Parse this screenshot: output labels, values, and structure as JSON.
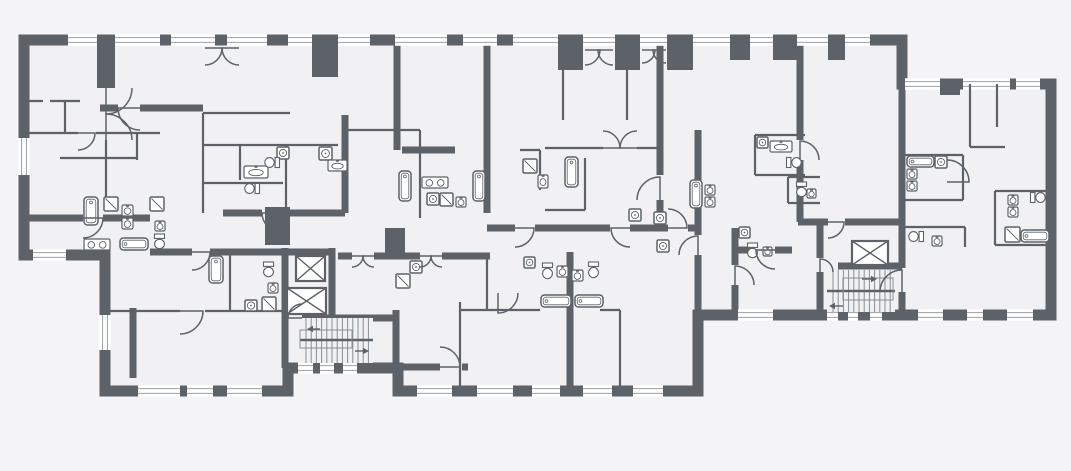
{
  "meta": {
    "kind": "architectural-floor-plan",
    "width": 1071,
    "height": 471
  },
  "palette": {
    "bg": "#f4f4f6",
    "room": "#f1f1f3",
    "wall": "#5c6268",
    "glass": "#9aa1a7",
    "tread": "#878e94",
    "white": "#ffffff"
  },
  "footprint": [
    [
      24,
      40
    ],
    [
      902,
      40
    ],
    [
      902,
      84
    ],
    [
      1051,
      84
    ],
    [
      1051,
      315
    ],
    [
      698,
      315
    ],
    [
      698,
      391
    ],
    [
      398,
      391
    ],
    [
      398,
      368
    ],
    [
      288,
      368
    ],
    [
      288,
      391
    ],
    [
      105,
      391
    ],
    [
      105,
      255
    ],
    [
      24,
      255
    ]
  ],
  "walls": [
    [
      397,
      45,
      397,
      150
    ],
    [
      345,
      115,
      345,
      213
    ],
    [
      402,
      150,
      455,
      150
    ],
    [
      487,
      45,
      487,
      213
    ],
    [
      660,
      45,
      660,
      175
    ],
    [
      660,
      200,
      660,
      228
    ],
    [
      800,
      45,
      800,
      140
    ],
    [
      800,
      160,
      800,
      222
    ],
    [
      902,
      84,
      902,
      268
    ],
    [
      902,
      292,
      902,
      315
    ],
    [
      820,
      222,
      820,
      258
    ],
    [
      820,
      272,
      820,
      315
    ],
    [
      735,
      228,
      735,
      265
    ],
    [
      735,
      285,
      735,
      315
    ],
    [
      285,
      248,
      285,
      368
    ],
    [
      332,
      248,
      332,
      318
    ],
    [
      223,
      213,
      262,
      213
    ],
    [
      280,
      213,
      345,
      213
    ],
    [
      150,
      252,
      192,
      252
    ],
    [
      210,
      252,
      332,
      252
    ],
    [
      487,
      228,
      515,
      228
    ],
    [
      535,
      228,
      610,
      228
    ],
    [
      630,
      228,
      668,
      228
    ],
    [
      688,
      228,
      698,
      228
    ],
    [
      698,
      130,
      698,
      235
    ],
    [
      698,
      255,
      698,
      315
    ],
    [
      338,
      256,
      352,
      256
    ],
    [
      374,
      256,
      420,
      256
    ],
    [
      442,
      256,
      490,
      256
    ],
    [
      736,
      250,
      755,
      250
    ],
    [
      775,
      250,
      792,
      250
    ],
    [
      798,
      222,
      828,
      222
    ],
    [
      845,
      222,
      902,
      222
    ],
    [
      838,
      266,
      902,
      266
    ],
    [
      302,
      318,
      396,
      318
    ],
    [
      396,
      310,
      396,
      368
    ],
    [
      24,
      218,
      83,
      218
    ],
    [
      103,
      218,
      150,
      218
    ],
    [
      100,
      108,
      118,
      108
    ],
    [
      140,
      108,
      203,
      108
    ],
    [
      133,
      308,
      133,
      378
    ],
    [
      570,
      252,
      570,
      391
    ],
    [
      398,
      367,
      440,
      367
    ],
    [
      462,
      367,
      468,
      367
    ]
  ],
  "piers": [
    [
      97,
      45,
      18,
      43
    ],
    [
      312,
      45,
      26,
      32
    ],
    [
      558,
      45,
      25,
      25
    ],
    [
      615,
      45,
      25,
      25
    ],
    [
      667,
      45,
      26,
      25
    ],
    [
      730,
      45,
      20,
      15
    ],
    [
      773,
      45,
      24,
      15
    ],
    [
      828,
      45,
      17,
      15
    ],
    [
      940,
      84,
      20,
      11
    ],
    [
      265,
      207,
      25,
      38
    ],
    [
      385,
      228,
      20,
      28
    ]
  ],
  "thin_walls": [
    [
      24,
      101,
      43,
      101
    ],
    [
      50,
      101,
      80,
      101
    ],
    [
      65,
      101,
      65,
      133
    ],
    [
      24,
      133,
      78,
      133
    ],
    [
      96,
      133,
      160,
      133
    ],
    [
      137,
      133,
      137,
      160
    ],
    [
      60,
      158,
      137,
      158
    ],
    [
      106,
      140,
      106,
      198
    ],
    [
      203,
      113,
      203,
      213
    ],
    [
      203,
      113,
      290,
      113
    ],
    [
      203,
      145,
      338,
      145
    ],
    [
      240,
      145,
      240,
      180
    ],
    [
      203,
      183,
      283,
      183
    ],
    [
      286,
      145,
      286,
      213
    ],
    [
      345,
      130,
      420,
      130
    ],
    [
      420,
      130,
      420,
      218
    ],
    [
      520,
      150,
      540,
      150
    ],
    [
      540,
      150,
      540,
      190
    ],
    [
      585,
      158,
      585,
      210
    ],
    [
      545,
      210,
      585,
      210
    ],
    [
      627,
      45,
      627,
      120
    ],
    [
      563,
      70,
      563,
      120
    ],
    [
      545,
      148,
      603,
      148
    ],
    [
      637,
      148,
      660,
      148
    ],
    [
      755,
      135,
      805,
      135
    ],
    [
      755,
      135,
      755,
      175
    ],
    [
      755,
      175,
      805,
      175
    ],
    [
      788,
      177,
      820,
      177
    ],
    [
      788,
      177,
      788,
      203
    ],
    [
      788,
      203,
      820,
      203
    ],
    [
      970,
      84,
      970,
      147
    ],
    [
      970,
      147,
      1005,
      147
    ],
    [
      997,
      84,
      997,
      127
    ],
    [
      905,
      155,
      963,
      155
    ],
    [
      963,
      155,
      963,
      200
    ],
    [
      905,
      200,
      963,
      200
    ],
    [
      995,
      191,
      1051,
      191
    ],
    [
      995,
      191,
      995,
      245
    ],
    [
      995,
      245,
      1051,
      245
    ],
    [
      905,
      227,
      965,
      227
    ],
    [
      965,
      227,
      965,
      247
    ],
    [
      105,
      311,
      180,
      311
    ],
    [
      205,
      311,
      283,
      311
    ],
    [
      230,
      252,
      230,
      311
    ],
    [
      460,
      302,
      460,
      388
    ],
    [
      620,
      310,
      620,
      391
    ],
    [
      487,
      256,
      487,
      310
    ],
    [
      460,
      310,
      540,
      310
    ],
    [
      600,
      310,
      620,
      310
    ]
  ],
  "windows": [
    [
      "h",
      68,
      40,
      29
    ],
    [
      "h",
      115,
      40,
      45
    ],
    [
      "h",
      171,
      40,
      44
    ],
    [
      "h",
      227,
      40,
      40
    ],
    [
      "h",
      288,
      40,
      24
    ],
    [
      "h",
      338,
      40,
      32
    ],
    [
      "h",
      395,
      40,
      52
    ],
    [
      "h",
      463,
      40,
      34
    ],
    [
      "h",
      513,
      40,
      45
    ],
    [
      "h",
      583,
      40,
      32
    ],
    [
      "h",
      640,
      40,
      27
    ],
    [
      "h",
      693,
      40,
      37
    ],
    [
      "h",
      750,
      40,
      23
    ],
    [
      "h",
      797,
      40,
      31
    ],
    [
      "h",
      845,
      40,
      25
    ],
    [
      "h",
      905,
      84,
      35
    ],
    [
      "h",
      963,
      84,
      47
    ],
    [
      "h",
      1016,
      84,
      24
    ],
    [
      "h",
      33,
      255,
      33
    ],
    [
      "h",
      298,
      368,
      15
    ],
    [
      "h",
      320,
      368,
      14
    ],
    [
      "h",
      343,
      368,
      14
    ],
    [
      "h",
      138,
      391,
      42
    ],
    [
      "h",
      187,
      391,
      26
    ],
    [
      "h",
      227,
      391,
      35
    ],
    [
      "h",
      417,
      391,
      35
    ],
    [
      "h",
      477,
      391,
      36
    ],
    [
      "h",
      532,
      391,
      28
    ],
    [
      "h",
      583,
      391,
      29
    ],
    [
      "h",
      633,
      391,
      30
    ],
    [
      "h",
      738,
      315,
      35
    ],
    [
      "h",
      827,
      315,
      11
    ],
    [
      "h",
      848,
      315,
      10
    ],
    [
      "h",
      870,
      315,
      12
    ],
    [
      "h",
      918,
      315,
      25
    ],
    [
      "h",
      967,
      315,
      16
    ],
    [
      "h",
      1007,
      315,
      26
    ],
    [
      "v",
      24,
      138,
      37
    ],
    [
      "v",
      105,
      315,
      35
    ]
  ],
  "elevators": [
    [
      296,
      256,
      29,
      25
    ],
    [
      287,
      288,
      39,
      26
    ],
    [
      852,
      241,
      36,
      24
    ]
  ],
  "stairs": [
    {
      "x": 300,
      "y": 318,
      "w": 73,
      "h": 45,
      "railY": 340,
      "box": [
        300,
        330,
        52,
        18
      ],
      "arrows": [
        [
          320,
          329,
          307,
          329
        ],
        [
          355,
          351,
          369,
          351
        ]
      ]
    },
    {
      "x": 827,
      "y": 270,
      "w": 68,
      "h": 42,
      "railY": 291,
      "box": [
        843,
        278,
        50,
        22
      ],
      "arrows": [
        [
          862,
          279,
          877,
          279
        ],
        [
          843,
          306,
          829,
          306
        ]
      ]
    }
  ],
  "fixtures": [
    [
      "tub",
      84,
      197,
      14,
      28,
      0
    ],
    [
      "shower",
      104,
      197,
      14,
      14,
      0
    ],
    [
      "sinkR",
      122,
      205,
      11,
      11,
      0
    ],
    [
      "sinkR",
      122,
      218,
      11,
      11,
      0
    ],
    [
      "shower",
      150,
      197,
      14,
      14,
      0
    ],
    [
      "sinkR",
      155,
      221,
      10,
      10,
      0
    ],
    [
      "toilet",
      154,
      234,
      11,
      15,
      0
    ],
    [
      "vanity2",
      84,
      239,
      26,
      11,
      0
    ],
    [
      "tub",
      120,
      238,
      28,
      12,
      0
    ],
    [
      "washer",
      277,
      147,
      12,
      12,
      0
    ],
    [
      "washer",
      319,
      147,
      13,
      13,
      0
    ],
    [
      "sink1",
      244,
      166,
      24,
      12,
      0
    ],
    [
      "toilet",
      266.5,
      155,
      11,
      15,
      90
    ],
    [
      "sink1",
      328,
      160,
      19,
      11,
      0
    ],
    [
      "toilet",
      246.5,
      181,
      11,
      15,
      90
    ],
    [
      "tub",
      209,
      256,
      14,
      27,
      0
    ],
    [
      "washer",
      245,
      300,
      12,
      11,
      0
    ],
    [
      "shower",
      262,
      297,
      14,
      14,
      0
    ],
    [
      "toilet",
      263,
      262,
      11,
      15,
      0
    ],
    [
      "sinkR",
      268,
      283,
      10,
      10,
      0
    ],
    [
      "tub",
      399,
      171,
      12,
      30,
      0
    ],
    [
      "tub",
      473,
      171,
      12,
      30,
      0
    ],
    [
      "vanity2",
      422,
      177,
      26,
      11,
      0
    ],
    [
      "washer",
      427,
      193,
      12,
      12,
      0
    ],
    [
      "shower",
      440,
      193,
      13,
      13,
      0
    ],
    [
      "sinkR",
      456,
      197,
      10,
      10,
      0
    ],
    [
      "shower",
      523,
      159,
      14,
      14,
      0
    ],
    [
      "sink1",
      538,
      175,
      10,
      13,
      0
    ],
    [
      "tub",
      565,
      157,
      13,
      30,
      0
    ],
    [
      "tub",
      690,
      180,
      12,
      28,
      0
    ],
    [
      "sinkR",
      705,
      185,
      10,
      10,
      0
    ],
    [
      "sinkR",
      705,
      197,
      10,
      10,
      0
    ],
    [
      "washer",
      629,
      209,
      12,
      12,
      0
    ],
    [
      "washer",
      654,
      212,
      12,
      12,
      0
    ],
    [
      "washer",
      657,
      240,
      12,
      12,
      0
    ],
    [
      "washer",
      757,
      137,
      11,
      11,
      0
    ],
    [
      "sink1",
      770,
      141,
      22,
      11,
      0
    ],
    [
      "toilet",
      788.5,
      155,
      11,
      15,
      -90
    ],
    [
      "toilet",
      796,
      182,
      11,
      15,
      0
    ],
    [
      "sinkR",
      807,
      189,
      9,
      9,
      0
    ],
    [
      "washer",
      739,
      227,
      11,
      11,
      0
    ],
    [
      "toilet",
      747,
      243,
      11,
      15,
      0
    ],
    [
      "sinkR",
      763,
      247,
      9,
      9,
      0
    ],
    [
      "washer",
      524,
      257,
      11,
      11,
      0
    ],
    [
      "toilet",
      542,
      263,
      11,
      16,
      0
    ],
    [
      "sinkR",
      557,
      266,
      11,
      11,
      0
    ],
    [
      "sinkR",
      572,
      270,
      11,
      11,
      0
    ],
    [
      "toilet",
      588,
      262,
      11,
      16,
      0
    ],
    [
      "tub",
      541,
      295,
      30,
      12,
      0
    ],
    [
      "tub",
      575,
      295,
      28,
      12,
      0
    ],
    [
      "washer",
      410,
      261,
      12,
      12,
      0
    ],
    [
      "shower",
      396,
      274,
      14,
      14,
      0
    ],
    [
      "tub",
      907,
      156,
      27,
      11,
      0
    ],
    [
      "washer",
      935,
      156,
      12,
      12,
      0
    ],
    [
      "sinkR",
      907,
      169,
      10,
      10,
      0
    ],
    [
      "sinkR",
      907,
      181,
      10,
      10,
      0
    ],
    [
      "sinkR",
      1008,
      195,
      10,
      10,
      0
    ],
    [
      "sinkR",
      1008,
      207,
      10,
      10,
      0
    ],
    [
      "toilet",
      1032.5,
      190,
      11,
      15,
      -90
    ],
    [
      "shower",
      1005,
      227,
      15,
      15,
      0
    ],
    [
      "tub",
      1021,
      230,
      28,
      12,
      0
    ],
    [
      "toilet",
      910.5,
      229,
      11,
      15,
      90
    ],
    [
      "sinkR",
      932,
      236,
      10,
      10,
      0
    ]
  ],
  "doors": [
    [
      83,
      218,
      20,
      0,
      1
    ],
    [
      140,
      108,
      22,
      0,
      -1
    ],
    [
      106,
      88,
      26,
      90,
      -1
    ],
    [
      106,
      140,
      26,
      -90,
      1
    ],
    [
      280,
      213,
      18,
      0,
      -1
    ],
    [
      192,
      252,
      18,
      0,
      1
    ],
    [
      302,
      318,
      14,
      180,
      1
    ],
    [
      515,
      228,
      19,
      0,
      1
    ],
    [
      630,
      228,
      19,
      0,
      -1
    ],
    [
      668,
      228,
      19,
      180,
      -1
    ],
    [
      698,
      255,
      19,
      -90,
      -1
    ],
    [
      735,
      285,
      19,
      -90,
      1
    ],
    [
      775,
      250,
      19,
      0,
      -1
    ],
    [
      820,
      272,
      13,
      -90,
      1
    ],
    [
      902,
      292,
      22,
      -90,
      -1
    ],
    [
      78,
      133,
      17,
      0,
      1
    ],
    [
      180,
      311,
      23,
      0,
      1
    ],
    [
      660,
      200,
      23,
      -90,
      -1
    ],
    [
      800,
      160,
      19,
      -90,
      1
    ],
    [
      947,
      182,
      22,
      180,
      -1
    ],
    [
      828,
      222,
      16,
      0,
      1
    ],
    [
      420,
      256,
      11,
      0,
      1
    ],
    [
      442,
      256,
      11,
      0,
      -1
    ],
    [
      603,
      148,
      17,
      180,
      -1
    ],
    [
      637,
      148,
      17,
      180,
      1
    ],
    [
      205,
      48,
      17,
      0,
      1
    ],
    [
      239,
      48,
      17,
      0,
      -1
    ],
    [
      585,
      50,
      15,
      0,
      1
    ],
    [
      613,
      50,
      15,
      0,
      -1
    ],
    [
      642,
      50,
      13,
      0,
      1
    ],
    [
      666,
      50,
      13,
      0,
      -1
    ],
    [
      440,
      367,
      20,
      180,
      -1
    ],
    [
      498,
      293,
      20,
      90,
      -1
    ],
    [
      352,
      256,
      11,
      0,
      1
    ],
    [
      374,
      256,
      11,
      0,
      -1
    ]
  ]
}
